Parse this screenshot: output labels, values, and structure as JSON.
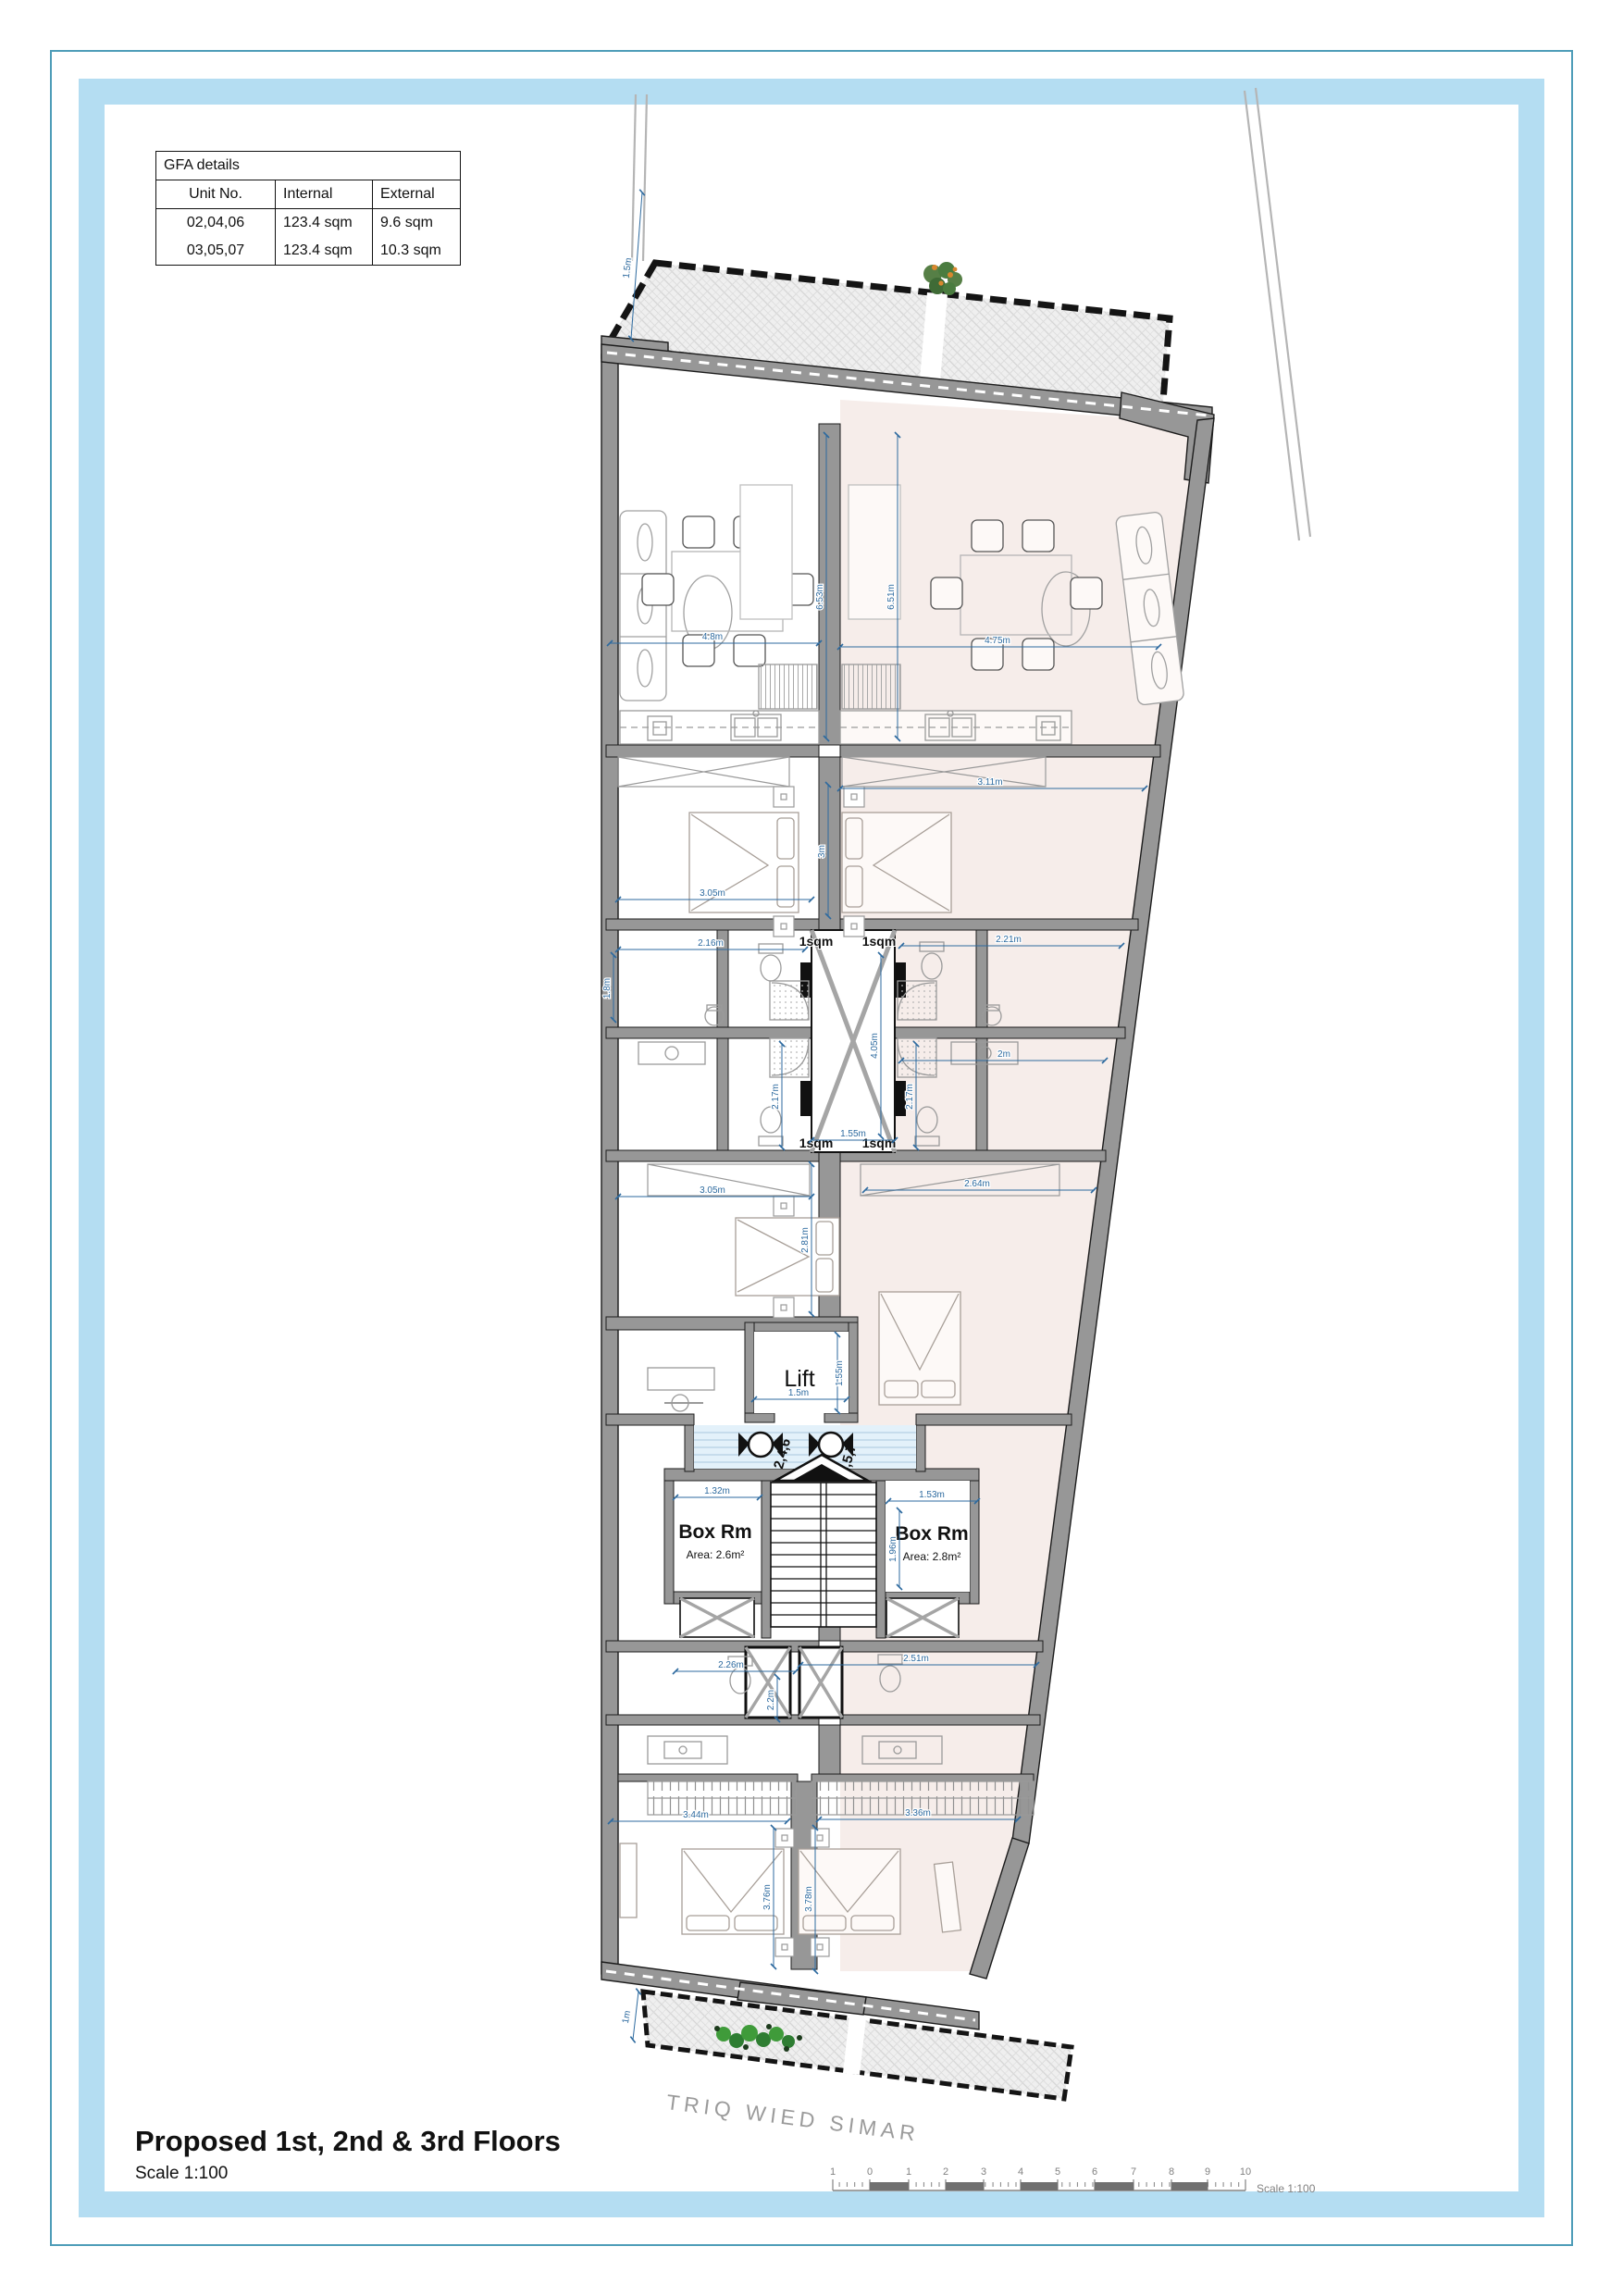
{
  "frame": {
    "border_color": "#4e9db8",
    "band_color": "#b4ddf2"
  },
  "gfa": {
    "title": "GFA details",
    "headers": [
      "Unit No.",
      "Internal",
      "External"
    ],
    "rows": [
      [
        "02,04,06",
        "123.4 sqm",
        "9.6 sqm"
      ],
      [
        "03,05,07",
        "123.4 sqm",
        "10.3 sqm"
      ]
    ]
  },
  "title_block": {
    "title": "Proposed 1st, 2nd & 3rd Floors",
    "scale": "Scale 1:100"
  },
  "street": {
    "name": "TRIQ WIED SIMAR"
  },
  "scalebar": {
    "labels": [
      "1",
      "0",
      "1",
      "2",
      "3",
      "4",
      "5",
      "6",
      "7",
      "8",
      "9",
      "10"
    ],
    "caption": "Scale 1:100"
  },
  "plan": {
    "rooms": {
      "lift": "Lift",
      "box_left": "Box Rm",
      "box_left_area": "Area: 2.6m²",
      "box_right": "Box Rm",
      "box_right_area": "Area: 2.8m²",
      "shaft": "1sqm"
    },
    "doors": {
      "left_units": "2,4,6",
      "right_units": "3,5,7"
    },
    "dims": {
      "terrace": "1.5m",
      "living_l_w": "4.8m",
      "living_r_w": "4.75m",
      "living_l_h": "6.53m",
      "living_r_h": "6.51m",
      "bed1_r_w": "3.11m",
      "bed1_l_h": "3m",
      "bed1_l_w": "3.05m",
      "bath_ul_w": "2.16m",
      "bath_ul_h": "1.8m",
      "bath_ur_w": "2.21m",
      "ensuite_r_w": "2m",
      "shaft_h": "4.05m",
      "shaft_w": "1.55m",
      "shower_l_h": "2.17m",
      "shower_r_h": "2.17m",
      "bed2_l_w": "3.05m",
      "bed2_l_h": "2.81m",
      "ward_r_w": "2.64m",
      "lift_w": "1.5m",
      "lift_h": "1.55m",
      "box_l_w": "1.32m",
      "box_r_w": "1.53m",
      "box_r_h": "1.96m",
      "bath_ll_w": "2.26m",
      "bath_lr_w": "2.51m",
      "shaft_low": "2.2m",
      "bed3_l_w": "3.44m",
      "bed3_r_w": "3.36m",
      "bed3_l_h": "3.76m",
      "bed3_r_h": "3.78m",
      "terrace_b": "1m"
    }
  }
}
